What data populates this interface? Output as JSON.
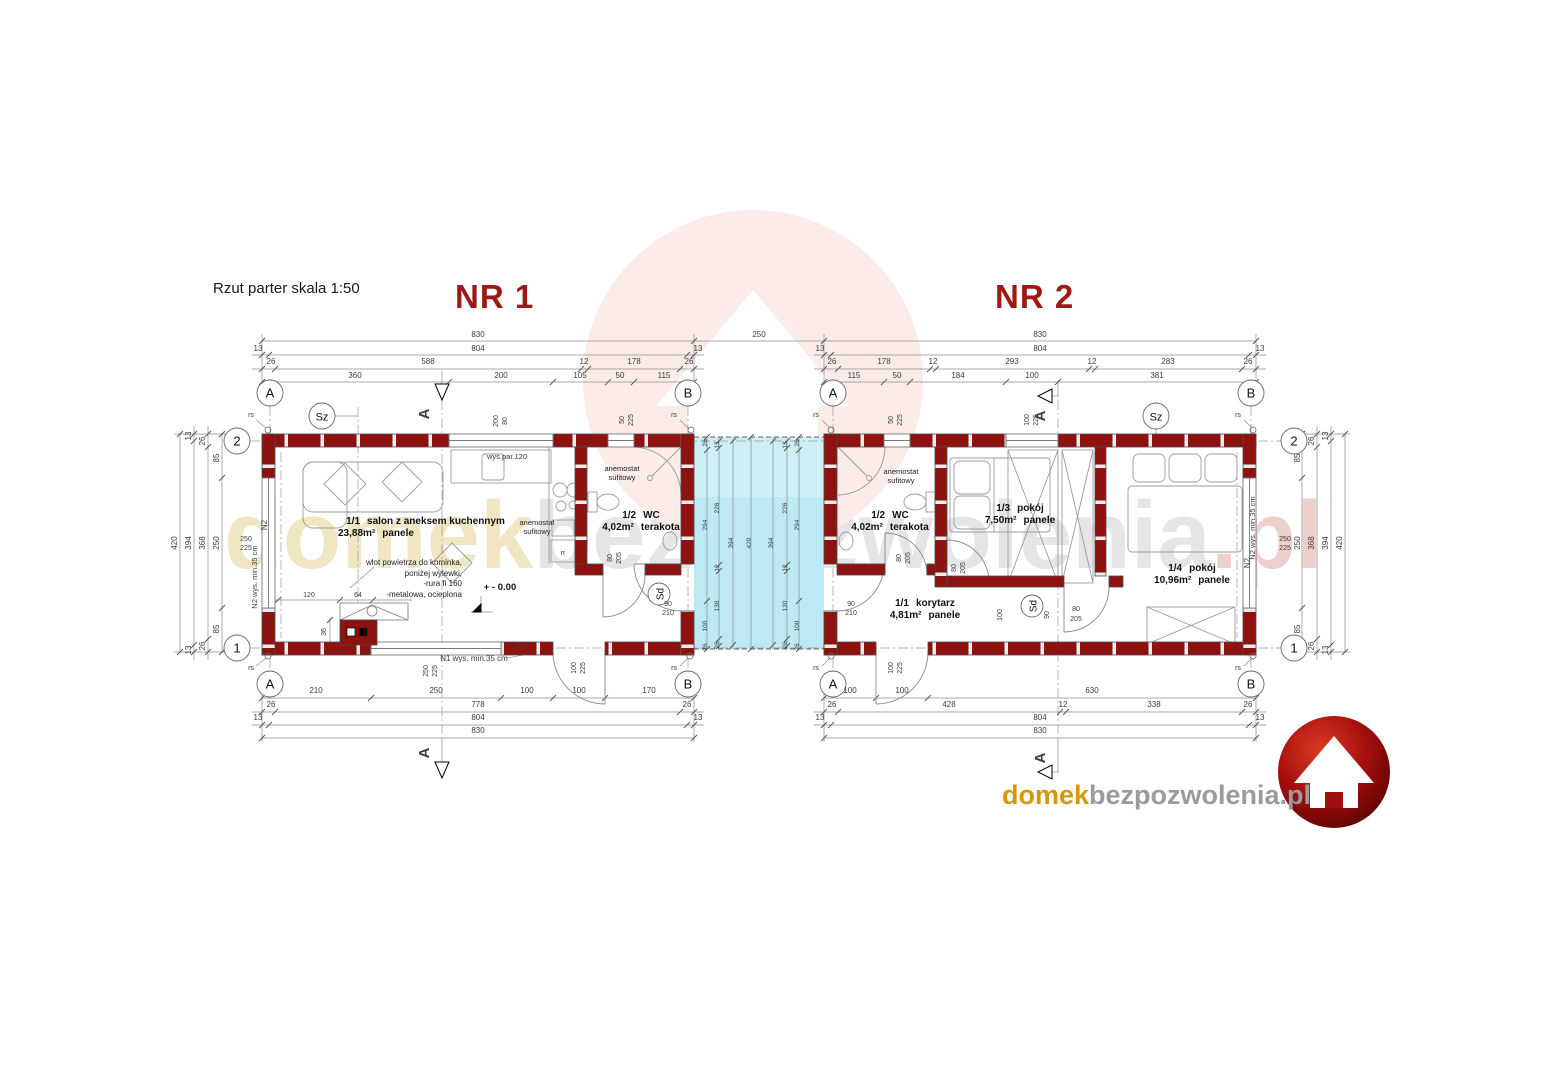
{
  "header": {
    "title": "Rzut parter skala 1:50",
    "unit1": "NR 1",
    "unit2": "NR 2"
  },
  "watermark": {
    "p1": "domek",
    "p2": "bezpozwolenia",
    "p3": ".pl"
  },
  "logo": {
    "p1": "domek",
    "p2": "bezpozwolenia.pl"
  },
  "rooms": {
    "salon": {
      "no": "1/1",
      "name": "salon z aneksem kuchennym",
      "area": "23,88m²",
      "floor": "panele"
    },
    "wc1": {
      "no": "1/2",
      "name": "WC",
      "area": "4,02m²",
      "floor": "terakota"
    },
    "wc2": {
      "no": "1/2",
      "name": "WC",
      "area": "4,02m²",
      "floor": "terakota"
    },
    "pokoj3": {
      "no": "1/3",
      "name": "pokój",
      "area": "7,50m²",
      "floor": "panele"
    },
    "pokoj4": {
      "no": "1/4",
      "name": "pokój",
      "area": "10,96m²",
      "floor": "panele"
    },
    "korytarz": {
      "no": "1/1",
      "name": "korytarz",
      "area": "4,81m²",
      "floor": "panele"
    }
  },
  "annotations": {
    "anemostat_l1": "anemostat",
    "anemostat_l2": "sufitowy",
    "chimney_note": [
      "wlot powietrza do kominka,",
      "poniżej wylewki,",
      "-rura fi 160",
      "-metalowa, ocieplona"
    ],
    "wys_par": "wys.par.120",
    "level": "+ - 0.00"
  },
  "colors": {
    "wall": "#8e1310",
    "terrace": "#bce9f3",
    "title_red": "#9c1a16",
    "logo_red": "#a50f0c",
    "wm_gold": "#d4980b",
    "wm_gray": "#9b9b9b"
  },
  "dims": [
    {
      "t": "830",
      "x": 478,
      "y": 337
    },
    {
      "t": "13",
      "x": 258,
      "y": 351
    },
    {
      "t": "804",
      "x": 478,
      "y": 351
    },
    {
      "t": "13",
      "x": 698,
      "y": 351
    },
    {
      "t": "26",
      "x": 271,
      "y": 364
    },
    {
      "t": "588",
      "x": 428,
      "y": 364
    },
    {
      "t": "12",
      "x": 584,
      "y": 364
    },
    {
      "t": "178",
      "x": 634,
      "y": 364
    },
    {
      "t": "26",
      "x": 689,
      "y": 364
    },
    {
      "t": "360",
      "x": 355,
      "y": 378
    },
    {
      "t": "200",
      "x": 501,
      "y": 378
    },
    {
      "t": "105",
      "x": 580,
      "y": 378
    },
    {
      "t": "50",
      "x": 620,
      "y": 378
    },
    {
      "t": "115",
      "x": 664,
      "y": 378
    },
    {
      "t": "250",
      "x": 759,
      "y": 337
    },
    {
      "t": "830",
      "x": 1040,
      "y": 337
    },
    {
      "t": "13",
      "x": 820,
      "y": 351
    },
    {
      "t": "804",
      "x": 1040,
      "y": 351
    },
    {
      "t": "13",
      "x": 1260,
      "y": 351
    },
    {
      "t": "26",
      "x": 832,
      "y": 364
    },
    {
      "t": "178",
      "x": 884,
      "y": 364
    },
    {
      "t": "12",
      "x": 933,
      "y": 364
    },
    {
      "t": "293",
      "x": 1012,
      "y": 364
    },
    {
      "t": "12",
      "x": 1092,
      "y": 364
    },
    {
      "t": "283",
      "x": 1168,
      "y": 364
    },
    {
      "t": "26",
      "x": 1248,
      "y": 364
    },
    {
      "t": "115",
      "x": 854,
      "y": 378
    },
    {
      "t": "50",
      "x": 897,
      "y": 378
    },
    {
      "t": "184",
      "x": 958,
      "y": 378
    },
    {
      "t": "100",
      "x": 1032,
      "y": 378
    },
    {
      "t": "381",
      "x": 1157,
      "y": 378
    },
    {
      "t": "210",
      "x": 316,
      "y": 693
    },
    {
      "t": "250",
      "x": 436,
      "y": 693
    },
    {
      "t": "100",
      "x": 527,
      "y": 693
    },
    {
      "t": "100",
      "x": 579,
      "y": 693
    },
    {
      "t": "170",
      "x": 649,
      "y": 693
    },
    {
      "t": "26",
      "x": 271,
      "y": 707
    },
    {
      "t": "778",
      "x": 478,
      "y": 707
    },
    {
      "t": "26",
      "x": 687,
      "y": 707
    },
    {
      "t": "13",
      "x": 258,
      "y": 720
    },
    {
      "t": "804",
      "x": 478,
      "y": 720
    },
    {
      "t": "13",
      "x": 698,
      "y": 720
    },
    {
      "t": "830",
      "x": 478,
      "y": 733
    },
    {
      "t": "100",
      "x": 850,
      "y": 693
    },
    {
      "t": "100",
      "x": 902,
      "y": 693
    },
    {
      "t": "630",
      "x": 1092,
      "y": 693
    },
    {
      "t": "26",
      "x": 832,
      "y": 707
    },
    {
      "t": "428",
      "x": 949,
      "y": 707
    },
    {
      "t": "12",
      "x": 1063,
      "y": 707
    },
    {
      "t": "338",
      "x": 1154,
      "y": 707
    },
    {
      "t": "26",
      "x": 1248,
      "y": 707
    },
    {
      "t": "13",
      "x": 820,
      "y": 720
    },
    {
      "t": "804",
      "x": 1040,
      "y": 720
    },
    {
      "t": "13",
      "x": 1260,
      "y": 720
    },
    {
      "t": "830",
      "x": 1040,
      "y": 733
    },
    {
      "t": "420",
      "x": 177,
      "y": 543,
      "r": 1
    },
    {
      "t": "13",
      "x": 191,
      "y": 436,
      "r": 1
    },
    {
      "t": "394",
      "x": 191,
      "y": 543,
      "r": 1
    },
    {
      "t": "13",
      "x": 191,
      "y": 650,
      "r": 1
    },
    {
      "t": "26",
      "x": 205,
      "y": 441,
      "r": 1
    },
    {
      "t": "368",
      "x": 205,
      "y": 543,
      "r": 1
    },
    {
      "t": "26",
      "x": 205,
      "y": 646,
      "r": 1
    },
    {
      "t": "85",
      "x": 219,
      "y": 458,
      "r": 1
    },
    {
      "t": "250",
      "x": 219,
      "y": 543,
      "r": 1
    },
    {
      "t": "85",
      "x": 219,
      "y": 629,
      "r": 1
    },
    {
      "t": "250",
      "x": 246,
      "y": 541,
      "s": 7
    },
    {
      "t": "225",
      "x": 246,
      "y": 550,
      "s": 7
    },
    {
      "t": "85",
      "x": 1300,
      "y": 458,
      "r": 1
    },
    {
      "t": "250",
      "x": 1300,
      "y": 543,
      "r": 1
    },
    {
      "t": "85",
      "x": 1300,
      "y": 629,
      "r": 1
    },
    {
      "t": "26",
      "x": 1314,
      "y": 441,
      "r": 1
    },
    {
      "t": "368",
      "x": 1314,
      "y": 543,
      "r": 1
    },
    {
      "t": "26",
      "x": 1314,
      "y": 646,
      "r": 1
    },
    {
      "t": "13",
      "x": 1328,
      "y": 436,
      "r": 1
    },
    {
      "t": "394",
      "x": 1328,
      "y": 543,
      "r": 1
    },
    {
      "t": "13",
      "x": 1328,
      "y": 650,
      "r": 1
    },
    {
      "t": "420",
      "x": 1342,
      "y": 543,
      "r": 1
    },
    {
      "t": "250",
      "x": 1285,
      "y": 541,
      "s": 7
    },
    {
      "t": "225",
      "x": 1285,
      "y": 550,
      "s": 7
    },
    {
      "t": "26",
      "x": 707,
      "y": 443,
      "r": 1,
      "s": 6.5
    },
    {
      "t": "294",
      "x": 707,
      "y": 525,
      "r": 1,
      "s": 6.5
    },
    {
      "t": "100",
      "x": 707,
      "y": 626,
      "r": 1,
      "s": 6.5
    },
    {
      "t": "26",
      "x": 707,
      "y": 647,
      "r": 1,
      "s": 6.5
    },
    {
      "t": "13",
      "x": 719,
      "y": 445,
      "r": 1,
      "s": 6.5
    },
    {
      "t": "226",
      "x": 719,
      "y": 508,
      "r": 1,
      "s": 6.5
    },
    {
      "t": "12",
      "x": 719,
      "y": 568,
      "r": 1,
      "s": 6.5
    },
    {
      "t": "130",
      "x": 719,
      "y": 606,
      "r": 1,
      "s": 6.5
    },
    {
      "t": "26",
      "x": 719,
      "y": 645,
      "r": 1,
      "s": 6.5
    },
    {
      "t": "394",
      "x": 733,
      "y": 543,
      "r": 1,
      "s": 6.5
    },
    {
      "t": "420",
      "x": 751,
      "y": 543,
      "r": 1,
      "s": 6.5
    },
    {
      "t": "394",
      "x": 773,
      "y": 543,
      "r": 1,
      "s": 6.5
    },
    {
      "t": "13",
      "x": 787,
      "y": 445,
      "r": 1,
      "s": 6.5
    },
    {
      "t": "226",
      "x": 787,
      "y": 508,
      "r": 1,
      "s": 6.5
    },
    {
      "t": "12",
      "x": 787,
      "y": 568,
      "r": 1,
      "s": 6.5
    },
    {
      "t": "130",
      "x": 787,
      "y": 606,
      "r": 1,
      "s": 6.5
    },
    {
      "t": "26",
      "x": 787,
      "y": 645,
      "r": 1,
      "s": 6.5
    },
    {
      "t": "26",
      "x": 799,
      "y": 443,
      "r": 1,
      "s": 6.5
    },
    {
      "t": "294",
      "x": 799,
      "y": 525,
      "r": 1,
      "s": 6.5
    },
    {
      "t": "100",
      "x": 799,
      "y": 626,
      "r": 1,
      "s": 6.5
    },
    {
      "t": "26",
      "x": 799,
      "y": 647,
      "r": 1,
      "s": 6.5
    },
    {
      "t": "200",
      "x": 498,
      "y": 421,
      "r": 1,
      "s": 7
    },
    {
      "t": "80",
      "x": 507,
      "y": 421,
      "r": 1,
      "s": 7
    },
    {
      "t": "50",
      "x": 624,
      "y": 420,
      "r": 1,
      "s": 7
    },
    {
      "t": "225",
      "x": 633,
      "y": 420,
      "r": 1,
      "s": 7
    },
    {
      "t": "250",
      "x": 428,
      "y": 671,
      "r": 1,
      "s": 7
    },
    {
      "t": "225",
      "x": 437,
      "y": 671,
      "r": 1,
      "s": 7
    },
    {
      "t": "100",
      "x": 576,
      "y": 668,
      "r": 1,
      "s": 7
    },
    {
      "t": "225",
      "x": 585,
      "y": 668,
      "r": 1,
      "s": 7
    },
    {
      "t": "50",
      "x": 893,
      "y": 420,
      "r": 1,
      "s": 7
    },
    {
      "t": "225",
      "x": 902,
      "y": 420,
      "r": 1,
      "s": 7
    },
    {
      "t": "100",
      "x": 1029,
      "y": 420,
      "r": 1,
      "s": 7
    },
    {
      "t": "225",
      "x": 1038,
      "y": 420,
      "r": 1,
      "s": 7
    },
    {
      "t": "100",
      "x": 893,
      "y": 668,
      "r": 1,
      "s": 7
    },
    {
      "t": "225",
      "x": 902,
      "y": 668,
      "r": 1,
      "s": 7
    },
    {
      "t": "80",
      "x": 612,
      "y": 558,
      "r": 1,
      "s": 7
    },
    {
      "t": "205",
      "x": 621,
      "y": 558,
      "r": 1,
      "s": 7
    },
    {
      "t": "80",
      "x": 901,
      "y": 558,
      "r": 1,
      "s": 7
    },
    {
      "t": "205",
      "x": 910,
      "y": 558,
      "r": 1,
      "s": 7
    },
    {
      "t": "80",
      "x": 956,
      "y": 568,
      "r": 1,
      "s": 7
    },
    {
      "t": "205",
      "x": 965,
      "y": 568,
      "r": 1,
      "s": 7
    },
    {
      "t": "90",
      "x": 668,
      "y": 606,
      "s": 7
    },
    {
      "t": "210",
      "x": 668,
      "y": 615,
      "s": 7
    },
    {
      "t": "90",
      "x": 851,
      "y": 606,
      "s": 7
    },
    {
      "t": "210",
      "x": 851,
      "y": 615,
      "s": 7
    },
    {
      "t": "80",
      "x": 1076,
      "y": 611,
      "s": 7
    },
    {
      "t": "205",
      "x": 1076,
      "y": 621,
      "s": 7
    },
    {
      "t": "100",
      "x": 1002,
      "y": 615,
      "r": 1,
      "s": 7
    },
    {
      "t": "90",
      "x": 1049,
      "y": 615,
      "r": 1,
      "s": 7
    },
    {
      "t": "120",
      "x": 309,
      "y": 597,
      "s": 7
    },
    {
      "t": "64",
      "x": 358,
      "y": 597,
      "s": 7
    },
    {
      "t": "36",
      "x": 326,
      "y": 632,
      "r": 1,
      "s": 7
    },
    {
      "t": "rs",
      "x": 251,
      "y": 417,
      "s": 7
    },
    {
      "t": "rs",
      "x": 674,
      "y": 417,
      "s": 7
    },
    {
      "t": "rs",
      "x": 816,
      "y": 417,
      "s": 7
    },
    {
      "t": "rs",
      "x": 1238,
      "y": 417,
      "s": 7
    },
    {
      "t": "rs",
      "x": 251,
      "y": 670,
      "s": 7
    },
    {
      "t": "rs",
      "x": 674,
      "y": 670,
      "s": 7
    },
    {
      "t": "rs",
      "x": 816,
      "y": 670,
      "s": 7
    },
    {
      "t": "rs",
      "x": 1238,
      "y": 670,
      "s": 7
    },
    {
      "t": "N1",
      "x": 520,
      "y": 649,
      "s": 8
    },
    {
      "t": "N1 wys. min.35 cm",
      "x": 474,
      "y": 661,
      "s": 8
    },
    {
      "t": "N2",
      "x": 267,
      "y": 525,
      "r": 1,
      "s": 8
    },
    {
      "t": "N2 wys. min.35 cm",
      "x": 257,
      "y": 577,
      "r": 1,
      "s": 7.5
    },
    {
      "t": "N2",
      "x": 1250,
      "y": 563,
      "r": 1,
      "s": 8
    },
    {
      "t": "N2 wys. min.35 cm",
      "x": 1255,
      "y": 528,
      "r": 1,
      "s": 7.5
    },
    {
      "t": "rr",
      "x": 563,
      "y": 555,
      "s": 7
    },
    {
      "t": "A",
      "x": 429,
      "y": 414,
      "r": 1,
      "s": 15,
      "b": 1
    },
    {
      "t": "A",
      "x": 429,
      "y": 753,
      "r": 1,
      "s": 15,
      "b": 1
    },
    {
      "t": "A",
      "x": 1045,
      "y": 416,
      "r": 1,
      "s": 15,
      "b": 1
    },
    {
      "t": "A",
      "x": 1045,
      "y": 758,
      "r": 1,
      "s": 15,
      "b": 1
    }
  ],
  "circles": [
    {
      "t": "A",
      "x": 270,
      "y": 393
    },
    {
      "t": "B",
      "x": 688,
      "y": 393
    },
    {
      "t": "A",
      "x": 833,
      "y": 393
    },
    {
      "t": "B",
      "x": 1251,
      "y": 393
    },
    {
      "t": "A",
      "x": 270,
      "y": 684
    },
    {
      "t": "B",
      "x": 688,
      "y": 684
    },
    {
      "t": "A",
      "x": 833,
      "y": 684
    },
    {
      "t": "B",
      "x": 1251,
      "y": 684
    },
    {
      "t": "2",
      "x": 237,
      "y": 441
    },
    {
      "t": "1",
      "x": 237,
      "y": 648
    },
    {
      "t": "2",
      "x": 1294,
      "y": 441
    },
    {
      "t": "1",
      "x": 1294,
      "y": 648
    },
    {
      "t": "Sz",
      "x": 322,
      "y": 416,
      "fs": 11
    },
    {
      "t": "Sz",
      "x": 1156,
      "y": 416,
      "fs": 11
    },
    {
      "t": "Sd",
      "x": 659,
      "y": 594,
      "rad": 11,
      "rot": 1,
      "fs": 10
    },
    {
      "t": "Sd",
      "x": 1032,
      "y": 606,
      "rad": 11,
      "rot": 1,
      "fs": 10
    }
  ]
}
